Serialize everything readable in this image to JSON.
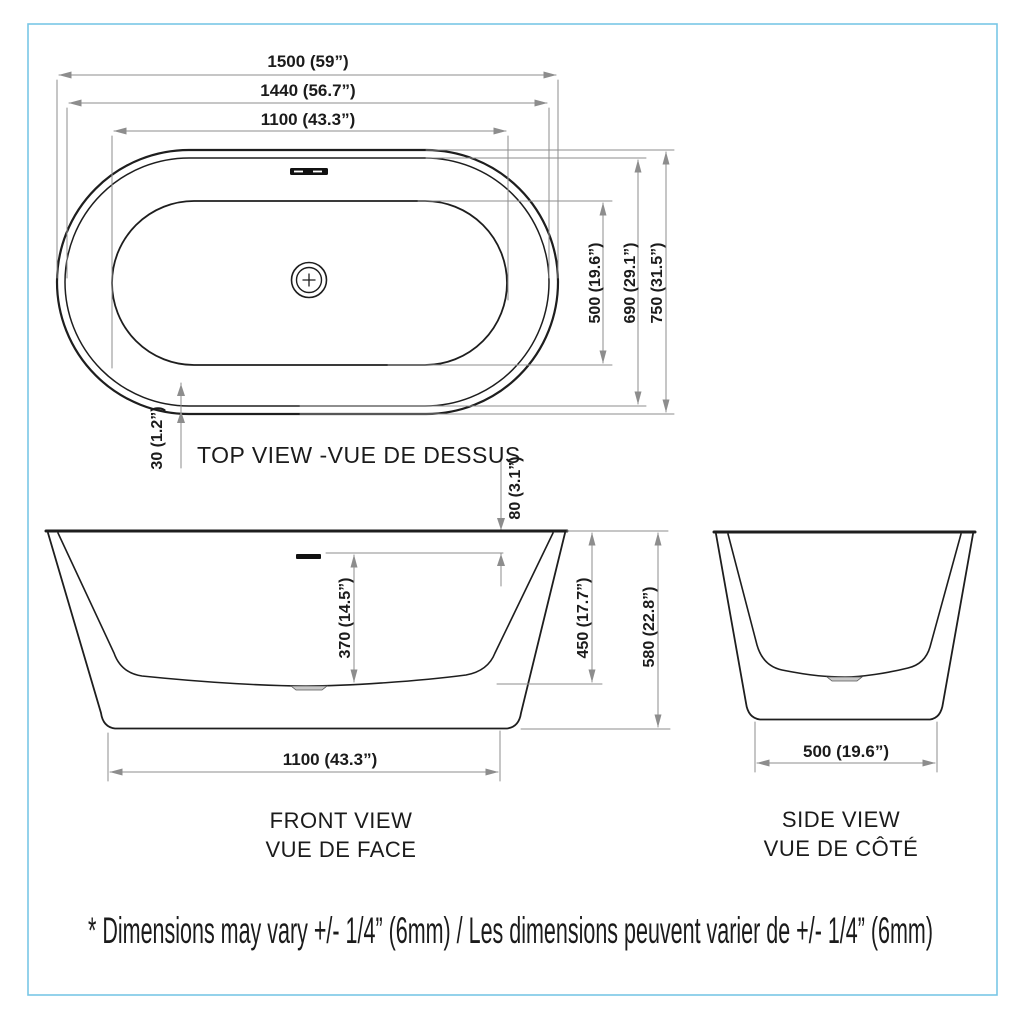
{
  "drawing": {
    "border_color": "#79c7e6",
    "line_color": "#1e1e1e",
    "dim_color": "#8d8d8d"
  },
  "top_view": {
    "title": "TOP VIEW -VUE DE DESSUS",
    "dims": {
      "overall_length": "1500 (59”)",
      "rim_length": "1440 (56.7”)",
      "basin_length": "1100 (43.3”)",
      "basin_width": "500 (19.6”)",
      "rim_width": "690 (29.1”)",
      "overall_width": "750 (31.5”)",
      "lip_width": "30 (1.2”)"
    }
  },
  "front_view": {
    "title_en": "FRONT VIEW",
    "title_fr": "VUE DE FACE",
    "dims": {
      "water_depth": "370 (14.5”)",
      "overflow_drop": "80 (3.1”)",
      "interior_depth": "450 (17.7”)",
      "overall_height": "580 (22.8”)",
      "base_length": "1100 (43.3”)"
    }
  },
  "side_view": {
    "title_en": "SIDE VIEW",
    "title_fr": "VUE DE CÔTÉ",
    "dims": {
      "base_width": "500 (19.6”)"
    }
  },
  "footnote": "* Dimensions may vary +/- 1/4” (6mm) / Les dimensions peuvent varier de +/- 1/4” (6mm)"
}
